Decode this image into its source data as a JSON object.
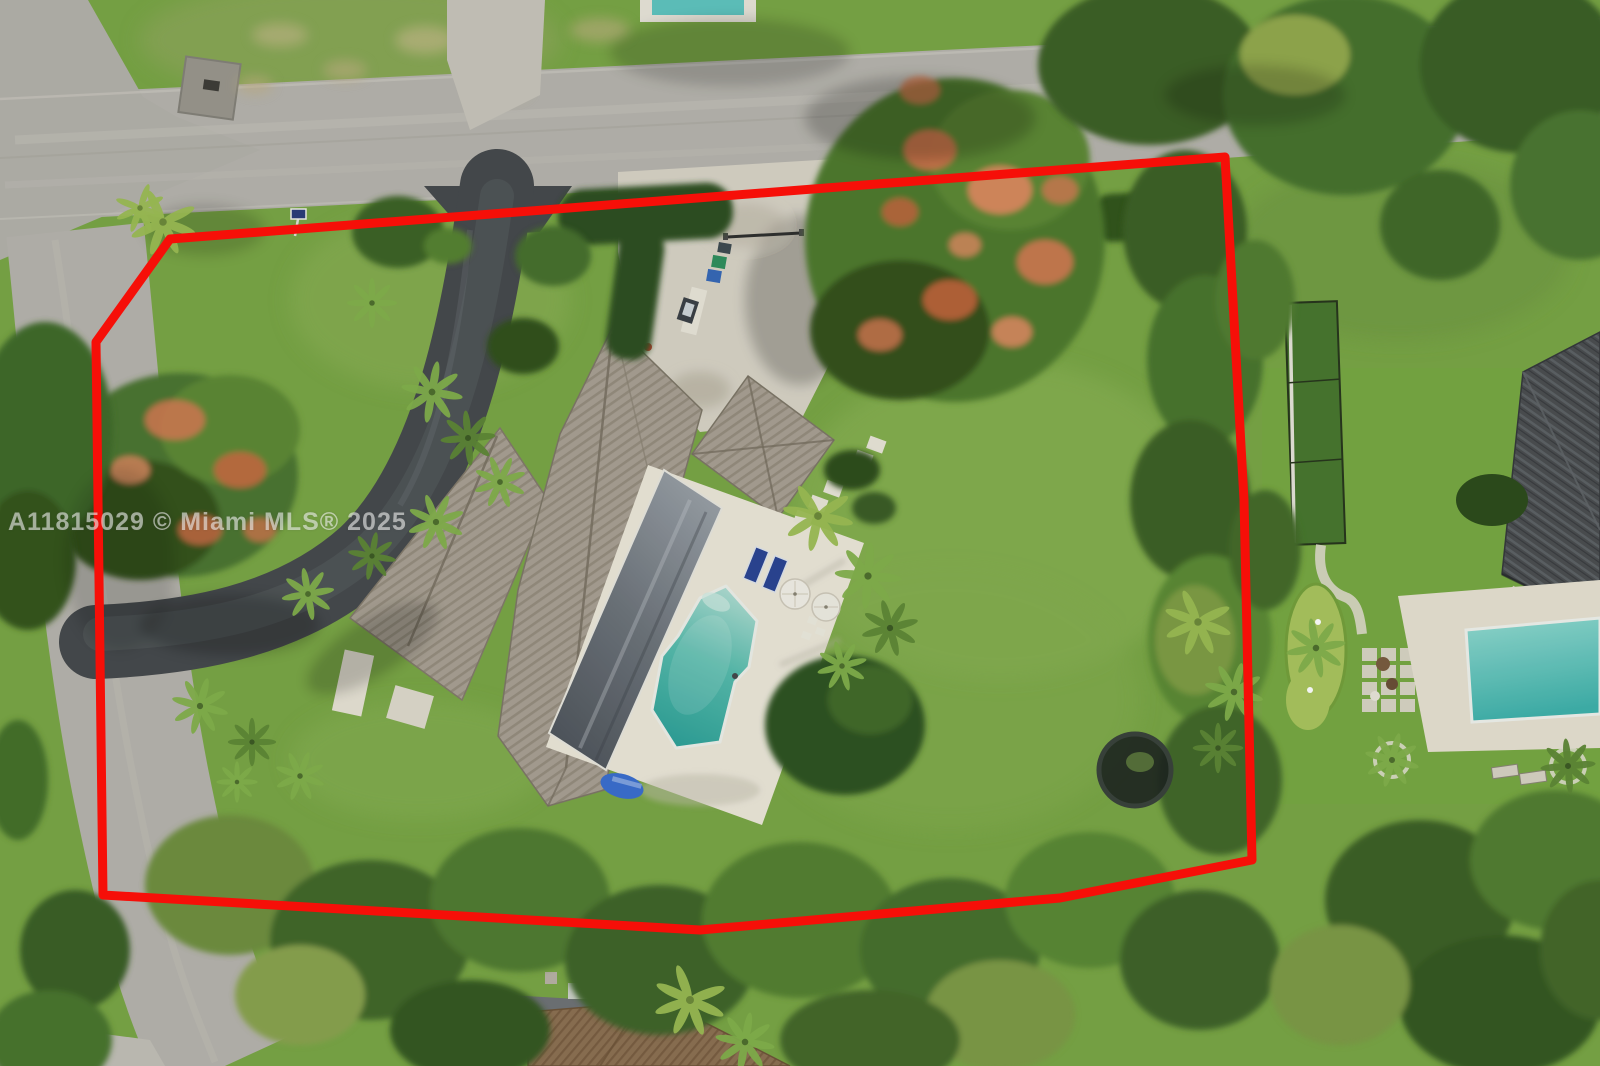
{
  "meta": {
    "kind": "aerial-drone-real-estate-photo",
    "description": "Overhead drone photo of a suburban pool home lot outlined with a red property-boundary overlay"
  },
  "watermark": {
    "text": "A11815029 © Miami MLS® 2025",
    "color": "rgba(255,255,255,0.55)"
  },
  "boundary": {
    "color": "#f60f08",
    "stroke_width": "9",
    "points": "170,239 1225,157 1244,500 1252,860 1060,898 700,930 103,895 96,342"
  },
  "palette": {
    "grass": "#7aa646",
    "grass_light": "#8fb75a",
    "road": "#b7b4ae",
    "road_streak": "#c8c5be",
    "asphalt": "#46494d",
    "courtyard": "#d8d3c7",
    "deck": "#ece7da",
    "roof_base": "#a9a094",
    "lanai_dark": "#565c64",
    "pool_shallow": "#aedcd2",
    "pool_deep": "#2fa29a",
    "poinciana_orange": "#d0754e",
    "tree_dark": "#3c6127",
    "tree_mid": "#4f7a31",
    "palm_green": "#83b04c",
    "neighbor_roof": "#4b4d51",
    "neighbor_pool": "#3fb2ac",
    "bottom_roof_brown": "#8d7053"
  },
  "scene": {
    "subject_lot": [
      "main-road",
      "side-road",
      "asphalt-circular-driveway",
      "entry-courtyard",
      "driveway-gate",
      "trash-bins",
      "for-sale-sign",
      "house-roof",
      "garage-wing-roof",
      "casita-roof",
      "screened-lanai",
      "pool-deck",
      "swimming-pool",
      "lounge-chairs",
      "patio-umbrellas",
      "stepping-pavers",
      "royal-poinciana-tree-large",
      "royal-poinciana-tree-left",
      "palm-trees",
      "hedges",
      "rear-tree-line"
    ],
    "neighbors": [
      "right-neighbor-metal-roof",
      "right-neighbor-pool",
      "putting-green",
      "batting-cage",
      "paver-patio",
      "bottom-neighbor-roof",
      "street-intersection",
      "utility-pad"
    ]
  }
}
